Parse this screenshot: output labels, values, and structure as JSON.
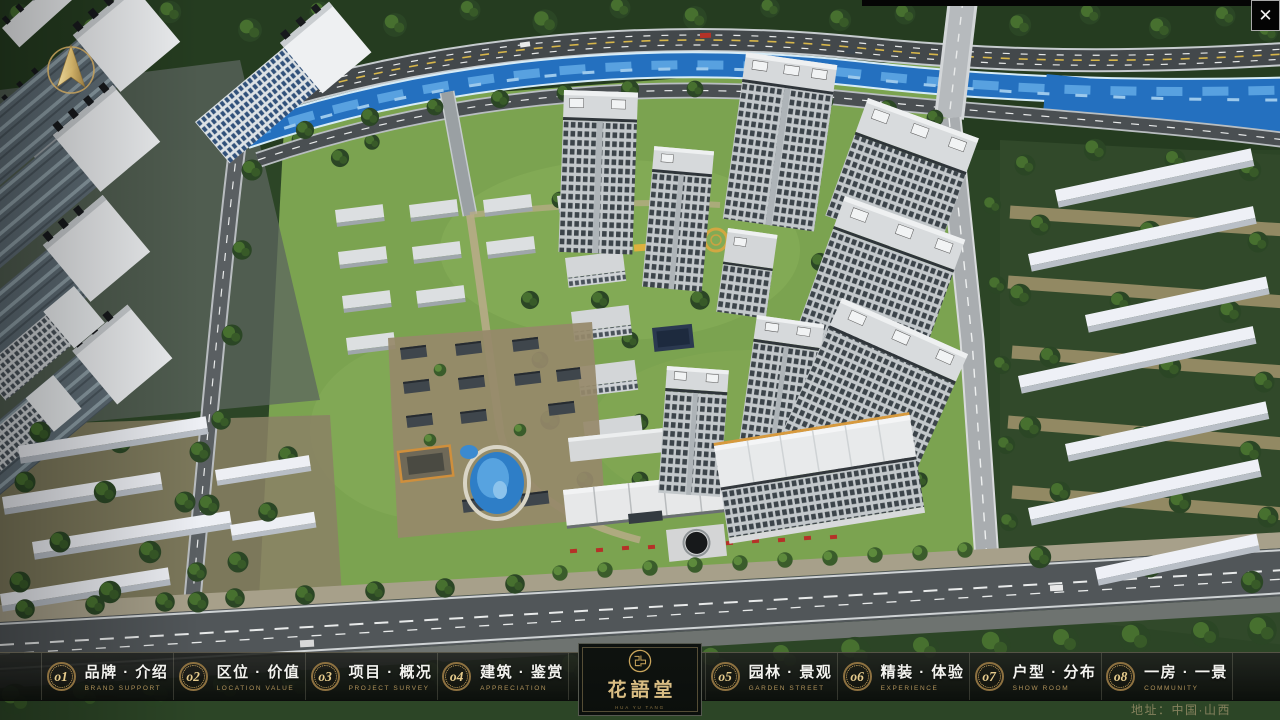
{
  "window_controls": {
    "close_icon": "✕"
  },
  "compass": {
    "icon": "north-arrow-compass"
  },
  "nav": {
    "items": [
      {
        "num_display": "o1",
        "title": "品牌 · 介绍",
        "subtitle": "BRAND SUPPORT"
      },
      {
        "num_display": "o2",
        "title": "区位 · 价值",
        "subtitle": "LOCATION VALUE"
      },
      {
        "num_display": "o3",
        "title": "项目 · 概况",
        "subtitle": "PROJECT SURVEY"
      },
      {
        "num_display": "o4",
        "title": "建筑 · 鉴赏",
        "subtitle": "APPRECIATION"
      },
      {
        "num_display": "o5",
        "title": "园林 · 景观",
        "subtitle": "GARDEN STREET"
      },
      {
        "num_display": "o6",
        "title": "精装 · 体验",
        "subtitle": "EXPERIENCE"
      },
      {
        "num_display": "o7",
        "title": "户型 · 分布",
        "subtitle": "SHOW ROOM"
      },
      {
        "num_display": "o8",
        "title": "一房 · 一景",
        "subtitle": "COMMUNITY"
      }
    ]
  },
  "logo": {
    "seal_icon": "huayutang-seal",
    "name": "花語堂",
    "tagline": "HUA YU TANG"
  },
  "footer": {
    "address": "地址：中国·山西"
  },
  "colors": {
    "gold_accent": "#c9a55c",
    "bar_background": "#101311",
    "river_blue": "#2470bf",
    "close_button_bg": "#040404"
  }
}
